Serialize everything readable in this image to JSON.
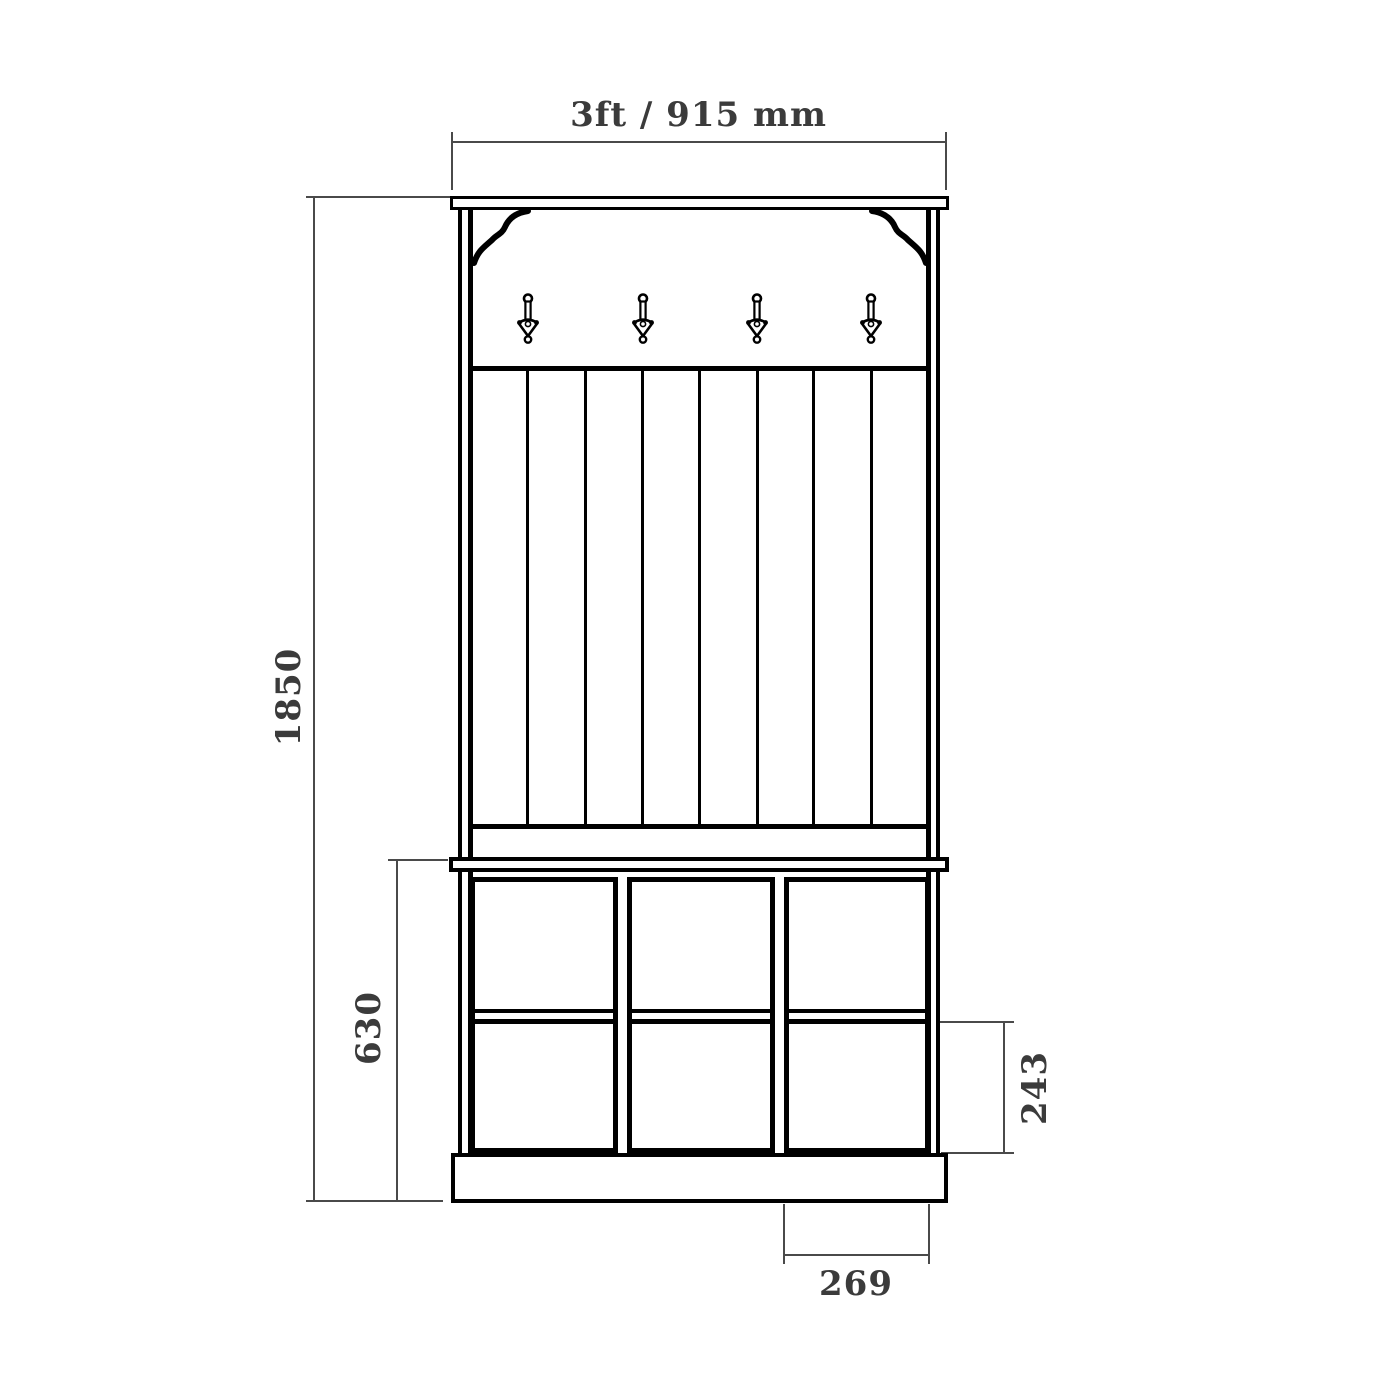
{
  "drawing": {
    "type": "furniture elevation dimension drawing",
    "subject": "hallway coat rack unit with hooks, bench seat and shoe cubbies",
    "colors": {
      "background": "#ffffff",
      "furniture_outline": "#000000",
      "dimension_lines": "#4a4a4a",
      "dimension_text": "#3b3b3b"
    },
    "dimensions": {
      "overall_width": {
        "label": "3ft / 915 mm"
      },
      "overall_height": {
        "label": "1850"
      },
      "lower_section_height": {
        "label": "630"
      },
      "cubby_height": {
        "label": "243"
      },
      "cubby_width": {
        "label": "269"
      }
    },
    "features": {
      "coat_hooks": 4,
      "back_slat_boards": 8,
      "cubby_columns": 3,
      "cubby_rows": 2,
      "cubbies_total": 6
    }
  }
}
